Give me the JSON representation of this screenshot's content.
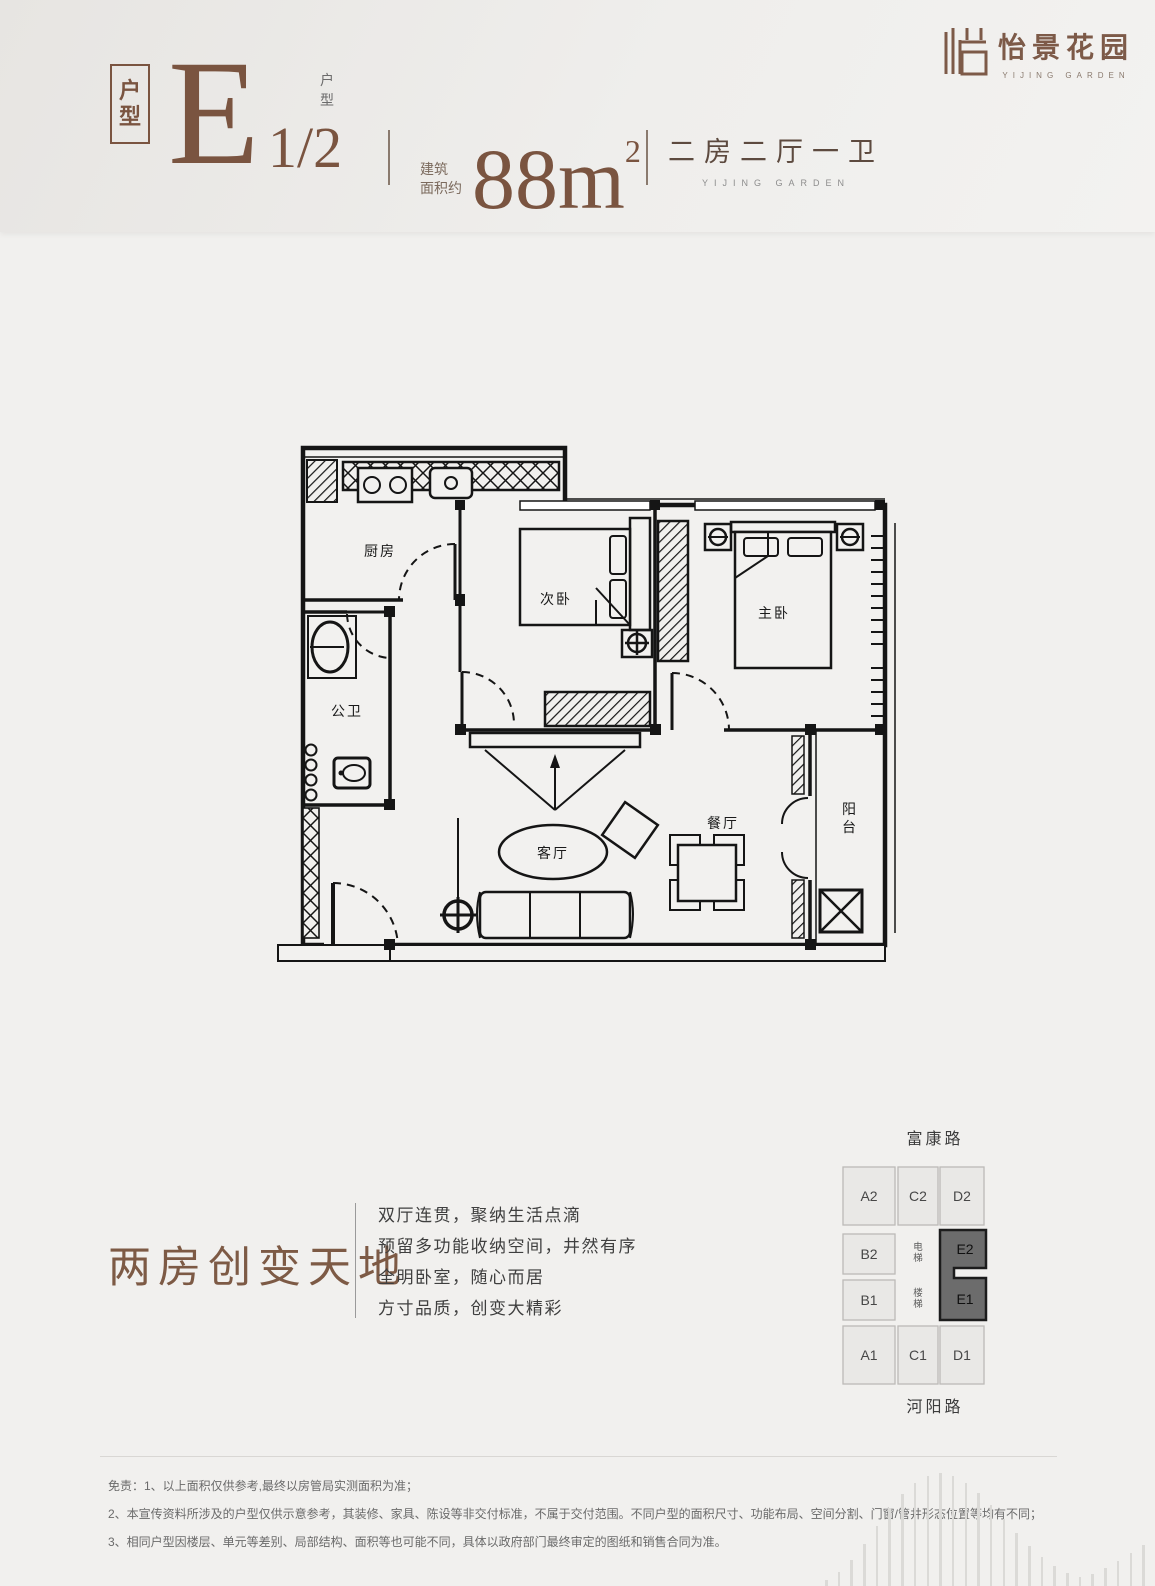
{
  "header": {
    "unit_box": "户型",
    "unit_letter": "E",
    "unit_fraction": "1/2",
    "unit_type_vertical": "户型",
    "area_label_line1": "建筑",
    "area_label_line2": "面积约",
    "area_value": "88m",
    "area_superscript": "2",
    "layout_text": "二房二厅一卫",
    "layout_subtext": "YIJING GARDEN"
  },
  "logo": {
    "name_cn": "怡景花园",
    "name_en": "YIJING GARDEN"
  },
  "floorplan": {
    "rooms": {
      "kitchen": "厨房",
      "bathroom": "公卫",
      "second_bedroom": "次卧",
      "master_bedroom": "主卧",
      "living_room": "客厅",
      "dining_room": "餐厅",
      "balcony": "阳台"
    }
  },
  "tagline": {
    "title": "两房创变天地",
    "lines": [
      "双厅连贯，聚纳生活点滴",
      "预留多功能收纳空间，井然有序",
      "全明卧室，随心而居",
      "方寸品质，创变大精彩"
    ]
  },
  "keyplan": {
    "road_top": "富康路",
    "road_bottom": "河阳路",
    "cells": [
      "A2",
      "C2",
      "D2",
      "B2",
      "B1",
      "A1",
      "C1",
      "D1"
    ],
    "highlighted_cells": [
      "E2",
      "E1"
    ],
    "elevator": "电梯",
    "stairs": "楼梯"
  },
  "disclaimer": {
    "lines": [
      "免责：1、以上面积仅供参考,最终以房管局实测面积为准；",
      "2、本宣传资料所涉及的户型仅供示意参考，其装修、家具、陈设等非交付标准，不属于交付范围。不同户型的面积尺寸、功能布局、空间分割、门窗/管井形态位置等均有不同；",
      "3、相同户型因楼层、单元等差别、局部结构、面积等也可能不同，具体以政府部门最终审定的图纸和销售合同为准。"
    ]
  },
  "colors": {
    "accent_brown": "#7a5440",
    "background": "#f1f0ee",
    "keyplan_highlight": "#6c6c6c"
  }
}
